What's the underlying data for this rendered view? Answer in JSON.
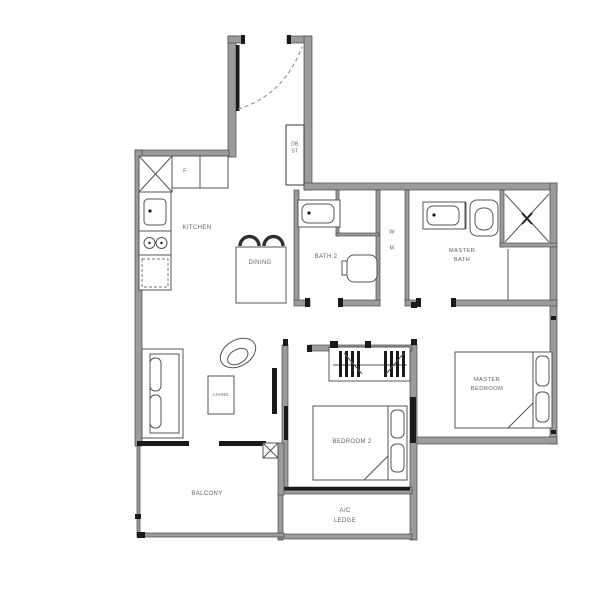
{
  "colors": {
    "wall": "#9b9b9b",
    "wall_edge": "#4a4a4a",
    "line": "#3a3a3a",
    "fixture": "#555555",
    "label": "#636363",
    "black": "#1a1a1a"
  },
  "rooms": {
    "kitchen": {
      "label": "KITCHEN"
    },
    "dining": {
      "label": "DINING"
    },
    "living": {
      "label": "LIVING"
    },
    "balcony": {
      "label": "BALCONY"
    },
    "bath2": {
      "label": "BATH 2"
    },
    "bedroom2": {
      "label": "BEDROOM 2"
    },
    "master_bath": {
      "line1": "MASTER",
      "line2": "BATH"
    },
    "master_bedroom": {
      "line1": "MASTER",
      "line2": "BEDROOM"
    },
    "ac_ledge": {
      "line1": "A/C",
      "line2": "LEDGE"
    },
    "db_store": {
      "line1": "DB",
      "line2": "ST"
    },
    "washer": {
      "line1": "W",
      "line2": "M"
    }
  },
  "fixtures": {
    "fridge_label": "F"
  }
}
